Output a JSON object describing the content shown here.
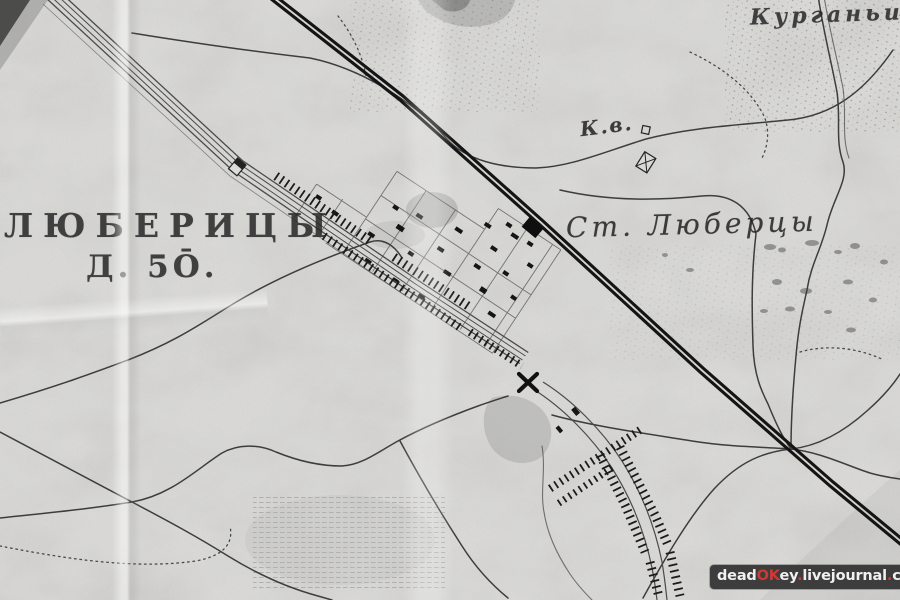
{
  "labels": {
    "village_name": "ЛЮБЕРИЦЫ",
    "village_info": "Д. 5Ō.",
    "station_name": "Ст. Люберцы",
    "area_name": "Курганьи",
    "poi_abbrev": "К.в."
  },
  "watermark": {
    "dead": "dead",
    "ok": "OK",
    "ey": "ey",
    "dot1": ".",
    "livejournal": "livejournal",
    "dot2": ".",
    "com": "com"
  },
  "colors": {
    "paper": "#d7d6d3",
    "ink": "#262626",
    "road": "#3d3d3d",
    "railway": "#141414",
    "watermark_bg": "#3d3d3d",
    "watermark_text": "#f0f0f0",
    "watermark_accent": "#cc3a33"
  }
}
